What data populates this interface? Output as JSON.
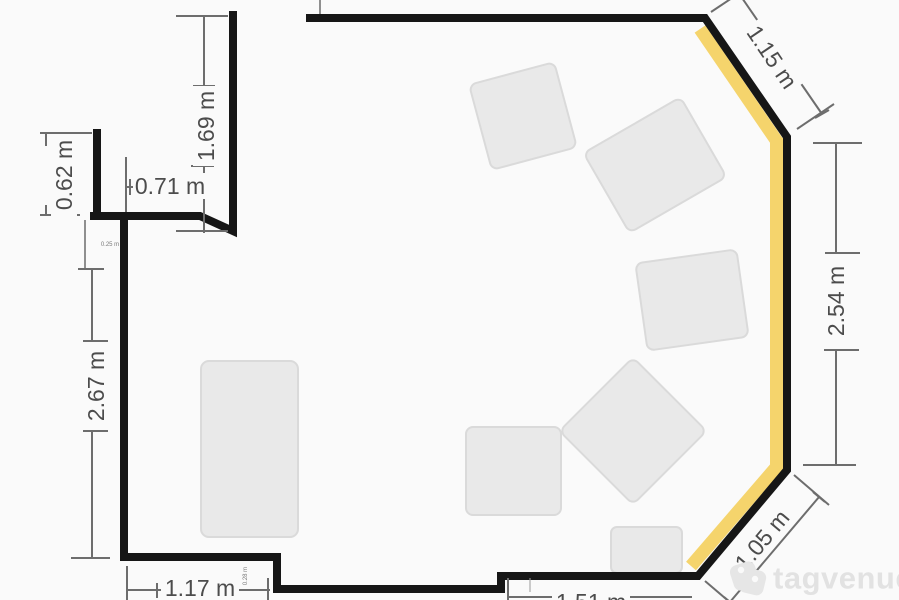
{
  "page": {
    "background": "#fafafa"
  },
  "floorplan": {
    "wall_color": "#161616",
    "highlight_color": "#f5d46c",
    "dimension_color": "#6d6d6d",
    "table_color": "#e9e9e9",
    "unit": "m",
    "labels": {
      "top_left_height": "1.69 m",
      "left_offset": "0.62 m",
      "top_opening_width": "0.71 m",
      "left_wall": "2.67 m",
      "bottom_left_wall": "1.17 m",
      "bottom_center_wall": "1.51 m",
      "top_right_wall": "1.15 m",
      "right_wall": "2.54 m",
      "bottom_right_wall": "1.05 m",
      "small_left_offset": "0.25 m",
      "small_bottom_step": "0.28 m"
    }
  },
  "watermark": {
    "brand": "tagvenue"
  }
}
